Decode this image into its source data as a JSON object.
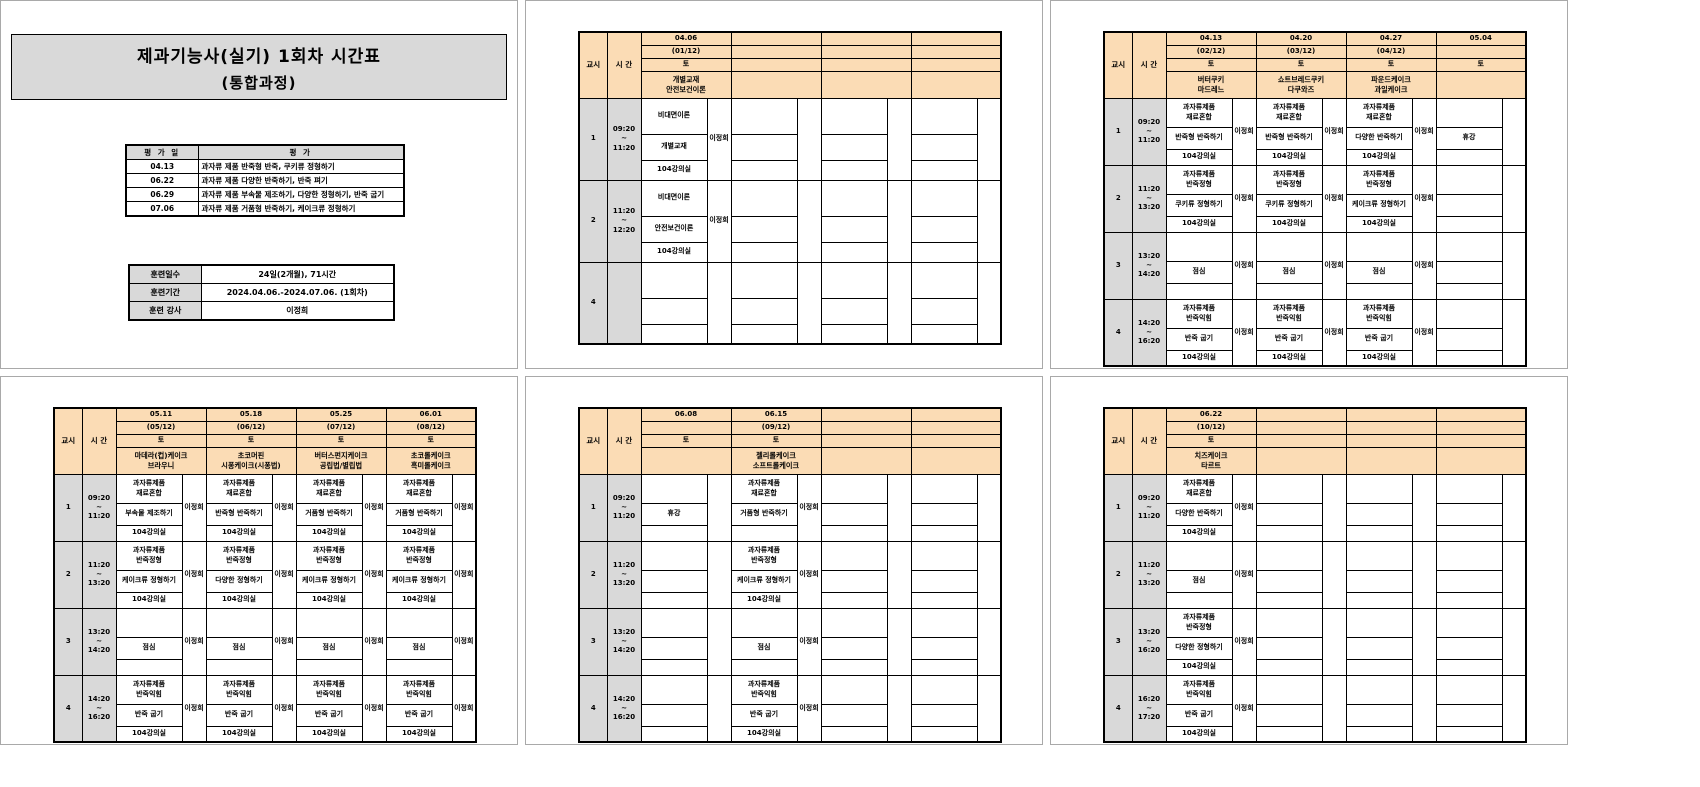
{
  "colors": {
    "header_fill": "#FBDCB5",
    "label_fill": "#D9D9D9",
    "table_border": "#000000",
    "page_border": "#A9A9A9"
  },
  "page1": {
    "title_line1": "제과기능사(실기) 1회차 시간표",
    "title_line2": "(통합과정)",
    "eval_table": {
      "date_header": "평 가 일",
      "content_header": "평            가",
      "rows": [
        {
          "date": "04.13",
          "content": "과자류 제품 반죽형 반죽, 쿠키류 정형하기"
        },
        {
          "date": "06.22",
          "content": "과자류 제품 다양한 반죽하기, 반죽 펴기"
        },
        {
          "date": "06.29",
          "content": "과자류 제품 부속물 제조하기, 다양한 정형하기, 반죽 굽기"
        },
        {
          "date": "07.06",
          "content": "과자류 제품 거품형 반죽하기, 케이크류 정형하기"
        }
      ]
    },
    "info_table": {
      "rows": [
        {
          "label": "훈련일수",
          "value": "24일(2개월), 71시간"
        },
        {
          "label": "훈련기간",
          "value": "2024.04.06.-2024.07.06. (1회차)"
        },
        {
          "label": "훈련 강사",
          "value": "이정희"
        }
      ]
    }
  },
  "schedule_common": {
    "period_header": "교시",
    "time_header": "시 간"
  },
  "schedule_pages": [
    {
      "columns": [
        {
          "date": "04.06",
          "week": "(01/12)",
          "day": "토",
          "subject": [
            "개별교재",
            "안전보건이론"
          ]
        },
        {
          "date": "",
          "week": "",
          "day": "",
          "subject": []
        },
        {
          "date": "",
          "week": "",
          "day": "",
          "subject": []
        },
        {
          "date": "",
          "week": "",
          "day": "",
          "subject": []
        }
      ],
      "rows": [
        {
          "period": "1",
          "time": [
            "09:20",
            "~",
            "11:20"
          ],
          "cells": [
            {
              "title": [
                "비대면이론"
              ],
              "activity": "개별교재",
              "room": "104강의실",
              "instructor": "이정희"
            },
            null,
            null,
            null
          ]
        },
        {
          "period": "2",
          "time": [
            "11:20",
            "~",
            "12:20"
          ],
          "cells": [
            {
              "title": [
                "비대면이론"
              ],
              "activity": "안전보건이론",
              "room": "104강의실",
              "instructor": "이정희"
            },
            null,
            null,
            null
          ]
        },
        {
          "period": "4",
          "time": [],
          "cells": [
            null,
            null,
            null,
            null
          ]
        }
      ]
    },
    {
      "columns": [
        {
          "date": "04.13",
          "week": "(02/12)",
          "day": "토",
          "subject": [
            "버터쿠키",
            "마드레느"
          ]
        },
        {
          "date": "04.20",
          "week": "(03/12)",
          "day": "토",
          "subject": [
            "쇼트브레드쿠키",
            "다쿠와즈"
          ]
        },
        {
          "date": "04.27",
          "week": "(04/12)",
          "day": "토",
          "subject": [
            "파운드케이크",
            "과일케이크"
          ]
        },
        {
          "date": "05.04",
          "week": "",
          "day": "토",
          "subject": []
        }
      ],
      "rows": [
        {
          "period": "1",
          "time": [
            "09:20",
            "~",
            "11:20"
          ],
          "cells": [
            {
              "title": [
                "과자류제품",
                "재료혼합"
              ],
              "activity": "반죽형 반죽하기",
              "room": "104강의실",
              "instructor": "이정희"
            },
            {
              "title": [
                "과자류제품",
                "재료혼합"
              ],
              "activity": "반죽형 반죽하기",
              "room": "104강의실",
              "instructor": "이정희"
            },
            {
              "title": [
                "과자류제품",
                "재료혼합"
              ],
              "activity": "다양한 반죽하기",
              "room": "104강의실",
              "instructor": "이정희"
            },
            {
              "title": [],
              "activity": "휴강",
              "room": "",
              "instructor": ""
            }
          ]
        },
        {
          "period": "2",
          "time": [
            "11:20",
            "~",
            "13:20"
          ],
          "cells": [
            {
              "title": [
                "과자류제품",
                "반죽정형"
              ],
              "activity": "쿠키류 정형하기",
              "room": "104강의실",
              "instructor": "이정희"
            },
            {
              "title": [
                "과자류제품",
                "반죽정형"
              ],
              "activity": "쿠키류 정형하기",
              "room": "104강의실",
              "instructor": "이정희"
            },
            {
              "title": [
                "과자류제품",
                "반죽정형"
              ],
              "activity": "케이크류 정형하기",
              "room": "104강의실",
              "instructor": "이정희"
            },
            null
          ]
        },
        {
          "period": "3",
          "time": [
            "13:20",
            "~",
            "14:20"
          ],
          "cells": [
            {
              "title": [],
              "activity": "점심",
              "room": "",
              "instructor": "이정희"
            },
            {
              "title": [],
              "activity": "점심",
              "room": "",
              "instructor": "이정희"
            },
            {
              "title": [],
              "activity": "점심",
              "room": "",
              "instructor": "이정희"
            },
            null
          ]
        },
        {
          "period": "4",
          "time": [
            "14:20",
            "~",
            "16:20"
          ],
          "cells": [
            {
              "title": [
                "과자류제품",
                "반죽익힘"
              ],
              "activity": "반죽 굽기",
              "room": "104강의실",
              "instructor": "이정희"
            },
            {
              "title": [
                "과자류제품",
                "반죽익힘"
              ],
              "activity": "반죽 굽기",
              "room": "104강의실",
              "instructor": "이정희"
            },
            {
              "title": [
                "과자류제품",
                "반죽익힘"
              ],
              "activity": "반죽 굽기",
              "room": "104강의실",
              "instructor": "이정희"
            },
            null
          ]
        }
      ]
    },
    {
      "columns": [
        {
          "date": "05.11",
          "week": "(05/12)",
          "day": "토",
          "subject": [
            "마데라(컵)케이크",
            "브라우니"
          ]
        },
        {
          "date": "05.18",
          "week": "(06/12)",
          "day": "토",
          "subject": [
            "초코머핀",
            "시퐁케이크(시퐁법)"
          ]
        },
        {
          "date": "05.25",
          "week": "(07/12)",
          "day": "토",
          "subject": [
            "버터스펀지케이크",
            "공립법/별립법"
          ]
        },
        {
          "date": "06.01",
          "week": "(08/12)",
          "day": "토",
          "subject": [
            "초코롤케이크",
            "흑미롤케이크"
          ]
        }
      ],
      "rows": [
        {
          "period": "1",
          "time": [
            "09:20",
            "~",
            "11:20"
          ],
          "cells": [
            {
              "title": [
                "과자류제품",
                "재료혼합"
              ],
              "activity": "부속물 제조하기",
              "room": "104강의실",
              "instructor": "이정희"
            },
            {
              "title": [
                "과자류제품",
                "재료혼합"
              ],
              "activity": "반죽형 반죽하기",
              "room": "104강의실",
              "instructor": "이정희"
            },
            {
              "title": [
                "과자류제품",
                "재료혼합"
              ],
              "activity": "거품형 반죽하기",
              "room": "104강의실",
              "instructor": "이정희"
            },
            {
              "title": [
                "과자류제품",
                "재료혼합"
              ],
              "activity": "거품형 반죽하기",
              "room": "104강의실",
              "instructor": "이정희"
            }
          ]
        },
        {
          "period": "2",
          "time": [
            "11:20",
            "~",
            "13:20"
          ],
          "cells": [
            {
              "title": [
                "과자류제품",
                "반죽정형"
              ],
              "activity": "케이크류 정형하기",
              "room": "104강의실",
              "instructor": "이정희"
            },
            {
              "title": [
                "과자류제품",
                "반죽정형"
              ],
              "activity": "다양한 정형하기",
              "room": "104강의실",
              "instructor": "이정희"
            },
            {
              "title": [
                "과자류제품",
                "반죽정형"
              ],
              "activity": "케이크류 정형하기",
              "room": "104강의실",
              "instructor": "이정희"
            },
            {
              "title": [
                "과자류제품",
                "반죽정형"
              ],
              "activity": "케이크류 정형하기",
              "room": "104강의실",
              "instructor": "이정희"
            }
          ]
        },
        {
          "period": "3",
          "time": [
            "13:20",
            "~",
            "14:20"
          ],
          "cells": [
            {
              "title": [],
              "activity": "점심",
              "room": "",
              "instructor": "이정희"
            },
            {
              "title": [],
              "activity": "점심",
              "room": "",
              "instructor": "이정희"
            },
            {
              "title": [],
              "activity": "점심",
              "room": "",
              "instructor": "이정희"
            },
            {
              "title": [],
              "activity": "점심",
              "room": "",
              "instructor": "이정희"
            }
          ]
        },
        {
          "period": "4",
          "time": [
            "14:20",
            "~",
            "16:20"
          ],
          "cells": [
            {
              "title": [
                "과자류제품",
                "반죽익힘"
              ],
              "activity": "반죽 굽기",
              "room": "104강의실",
              "instructor": "이정희"
            },
            {
              "title": [
                "과자류제품",
                "반죽익힘"
              ],
              "activity": "반죽 굽기",
              "room": "104강의실",
              "instructor": "이정희"
            },
            {
              "title": [
                "과자류제품",
                "반죽익힘"
              ],
              "activity": "반죽 굽기",
              "room": "104강의실",
              "instructor": "이정희"
            },
            {
              "title": [
                "과자류제품",
                "반죽익힘"
              ],
              "activity": "반죽 굽기",
              "room": "104강의실",
              "instructor": "이정희"
            }
          ]
        }
      ]
    },
    {
      "columns": [
        {
          "date": "06.08",
          "week": "",
          "day": "토",
          "subject": []
        },
        {
          "date": "06.15",
          "week": "(09/12)",
          "day": "토",
          "subject": [
            "젤리롤케이크",
            "소프트롤케이크"
          ]
        },
        {
          "date": "",
          "week": "",
          "day": "",
          "subject": []
        },
        {
          "date": "",
          "week": "",
          "day": "",
          "subject": []
        }
      ],
      "rows": [
        {
          "period": "1",
          "time": [
            "09:20",
            "~",
            "11:20"
          ],
          "cells": [
            {
              "title": [],
              "activity": "휴강",
              "room": "",
              "instructor": ""
            },
            {
              "title": [
                "과자류제품",
                "재료혼합"
              ],
              "activity": "거품형 반죽하기",
              "room": "",
              "instructor": "이정희"
            },
            null,
            null
          ]
        },
        {
          "period": "2",
          "time": [
            "11:20",
            "~",
            "13:20"
          ],
          "cells": [
            null,
            {
              "title": [
                "과자류제품",
                "반죽정형"
              ],
              "activity": "케이크류 정형하기",
              "room": "104강의실",
              "instructor": "이정희"
            },
            null,
            null
          ]
        },
        {
          "period": "3",
          "time": [
            "13:20",
            "~",
            "14:20"
          ],
          "cells": [
            null,
            {
              "title": [],
              "activity": "점심",
              "room": "",
              "instructor": "이정희"
            },
            null,
            null
          ]
        },
        {
          "period": "4",
          "time": [
            "14:20",
            "~",
            "16:20"
          ],
          "cells": [
            null,
            {
              "title": [
                "과자류제품",
                "반죽익힘"
              ],
              "activity": "반죽 굽기",
              "room": "104강의실",
              "instructor": "이정희"
            },
            null,
            null
          ]
        }
      ]
    },
    {
      "columns": [
        {
          "date": "06.22",
          "week": "(10/12)",
          "day": "토",
          "subject": [
            "치즈케이크",
            "타르트"
          ]
        },
        {
          "date": "",
          "week": "",
          "day": "",
          "subject": []
        },
        {
          "date": "",
          "week": "",
          "day": "",
          "subject": []
        },
        {
          "date": "",
          "week": "",
          "day": "",
          "subject": []
        }
      ],
      "rows": [
        {
          "period": "1",
          "time": [
            "09:20",
            "~",
            "11:20"
          ],
          "cells": [
            {
              "title": [
                "과자류제품",
                "재료혼합"
              ],
              "activity": "다양한 반죽하기",
              "room": "104강의실",
              "instructor": "이정희"
            },
            null,
            null,
            null
          ]
        },
        {
          "period": "2",
          "time": [
            "11:20",
            "~",
            "13:20"
          ],
          "cells": [
            {
              "title": [],
              "activity": "점심",
              "room": "",
              "instructor": "이정희"
            },
            null,
            null,
            null
          ]
        },
        {
          "period": "3",
          "time": [
            "13:20",
            "~",
            "16:20"
          ],
          "cells": [
            {
              "title": [
                "과자류제품",
                "반죽정형"
              ],
              "activity": "다양한 정형하기",
              "room": "104강의실",
              "instructor": "이정희"
            },
            null,
            null,
            null
          ]
        },
        {
          "period": "4",
          "time": [
            "16:20",
            "~",
            "17:20"
          ],
          "cells": [
            {
              "title": [
                "과자류제품",
                "반죽익힘"
              ],
              "activity": "반죽 굽기",
              "room": "104강의실",
              "instructor": "이정희"
            },
            null,
            null,
            null
          ]
        }
      ]
    }
  ]
}
